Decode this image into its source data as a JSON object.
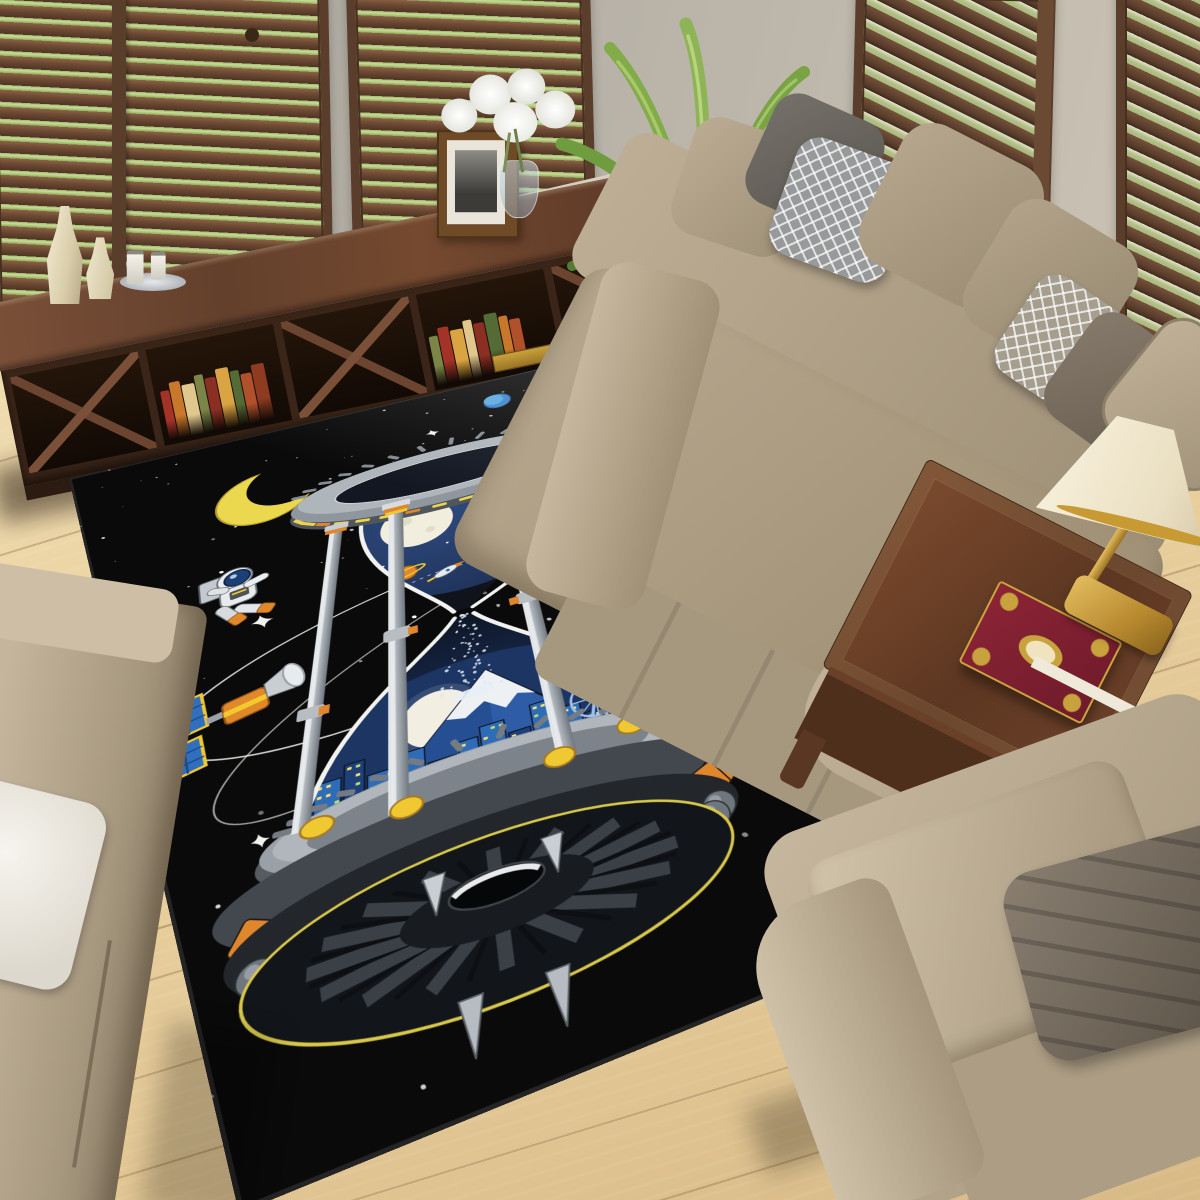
{
  "meta": {
    "title": "Living room photo with black space-themed hourglass area rug",
    "type": "product-photo"
  },
  "room": {
    "wall_color": "#b2ada3",
    "right_wall_color": "#c6beb0",
    "floor_color": "#ead29f",
    "furniture": [
      "window-shutters-left-1",
      "window-shutters-left-2",
      "window-shutters-right-1",
      "window-shutters-right-2",
      "tv-console",
      "cream-vases",
      "candle-tray",
      "shelf-books",
      "picture-frame",
      "white-flower-vase",
      "palm-plant",
      "main-sofa",
      "throw-pillows",
      "left-sofa",
      "white-pillow",
      "coffee-table",
      "table-lamp",
      "ornate-book",
      "armchair",
      "dark-armchair-pillow"
    ],
    "shutter_color": "#6e4a34",
    "foliage_color": "#9fb868",
    "wood_console": "#63402c",
    "wood_table": "#6a3f26",
    "sofa_beige": "#b2a38a",
    "pillow_gray": "#66625c",
    "pillow_diamond": "#8f9799",
    "lamp_shade": "#f5edd6",
    "lamp_gold": "#b8892f"
  },
  "rug": {
    "background": "#0a0a0a",
    "artwork": "cosmic hourglass space station with astronauts",
    "elements": [
      "crescent-moon",
      "blue-planet",
      "striped-planet",
      "star-field",
      "sparkle-stars",
      "orbit-lines",
      "space-station-ring",
      "glass-top-bulb",
      "sun",
      "full-moon",
      "saturn-and-rocket",
      "sand-stream",
      "glass-bottom-bulb",
      "mount-fuji",
      "night-city-skyline",
      "ferris-wheel",
      "support-columns",
      "ufo-turbine-base",
      "astronaut-left",
      "astronaut-right",
      "satellite"
    ],
    "colors": {
      "moon_yellow": "#ecd84e",
      "accent_gold": "#f0c832",
      "accent_orange": "#e0862c",
      "metal_light": "#d8dcdf",
      "metal_mid": "#8f969d",
      "metal_dark": "#50565c",
      "space_navy": "#23365c",
      "city_blue": "#2f6cb8",
      "glass_white": "#f2f3f0",
      "suit_white": "#e8ebed",
      "visor_navy": "#1c3f77",
      "boot_orange": "#e0882a"
    }
  }
}
